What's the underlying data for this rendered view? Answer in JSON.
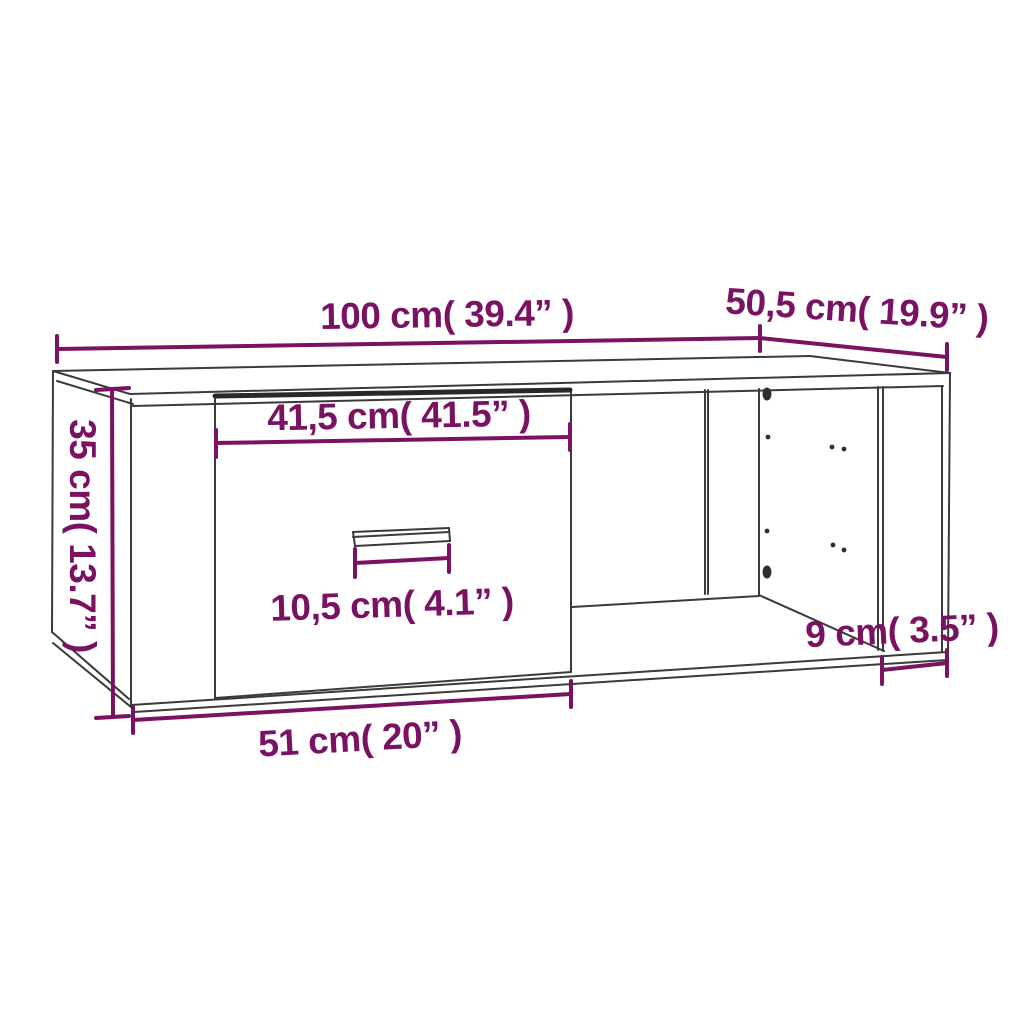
{
  "page": {
    "subject": "Coffee table dimension diagram with one drawer and an open side compartment",
    "background_color": "#ffffff"
  },
  "style": {
    "outline_color": "#3a3a3a",
    "drawer_gap_color": "#282828",
    "dimension_color": "#7a1263"
  },
  "dimensions": {
    "top_width": "100 cm( 39.4” )",
    "top_depth": "50,5 cm( 19.9” )",
    "side_height": "35 cm( 13.7” )",
    "drawer_front_width": "41,5 cm( 41.5” )",
    "handle_width": "10,5 cm( 4.1” )",
    "right_clearance": "9 cm( 3.5” )",
    "bottom_width": "51 cm( 20” )"
  }
}
